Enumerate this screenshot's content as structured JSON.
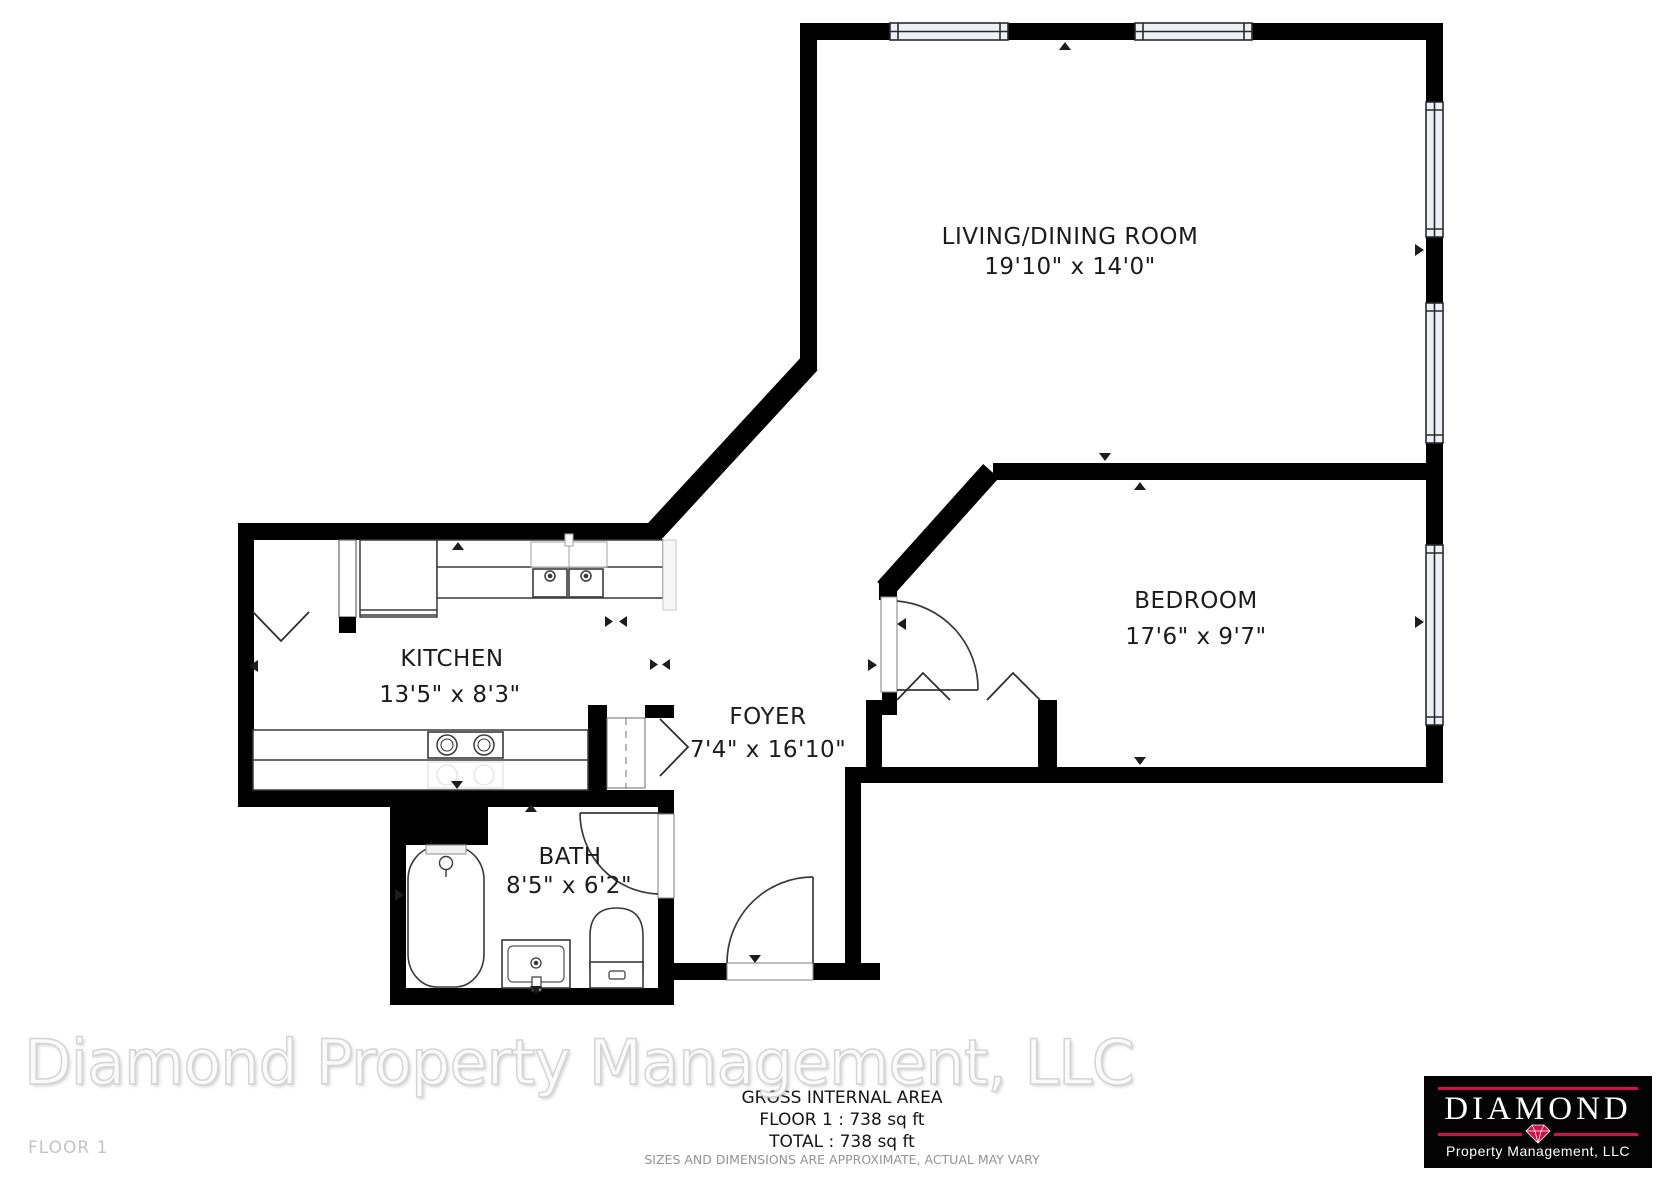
{
  "rooms": [
    {
      "name": "LIVING/DINING ROOM",
      "dims": "19'10\" x 14'0\""
    },
    {
      "name": "BEDROOM",
      "dims": "17'6\" x 9'7\""
    },
    {
      "name": "KITCHEN",
      "dims": "13'5\" x 8'3\""
    },
    {
      "name": "FOYER",
      "dims": "7'4\" x 16'10\""
    },
    {
      "name": "BATH",
      "dims": "8'5\" x 6'2\""
    }
  ],
  "footer": {
    "gross_area_title": "GROSS INTERNAL AREA",
    "floor_area": "FLOOR 1 : 738 sq ft",
    "total_area": "TOTAL : 738 sq ft",
    "disclaimer": "SIZES AND DIMENSIONS ARE APPROXIMATE, ACTUAL MAY VARY",
    "floor_label": "FLOOR 1"
  },
  "watermark": {
    "text": "Diamond Property Management, LLC",
    "color": "#f5f5f5"
  },
  "logo": {
    "brand": "DIAMOND",
    "subtitle": "Property Management, LLC",
    "bg": "#030303",
    "accent": "#ce1148"
  },
  "colors": {
    "wall": "#000000",
    "fixture_stroke": "#333333",
    "window_fill": "#eef0f8",
    "label_text": "#1b1b1b",
    "muted_text": "#949494"
  }
}
